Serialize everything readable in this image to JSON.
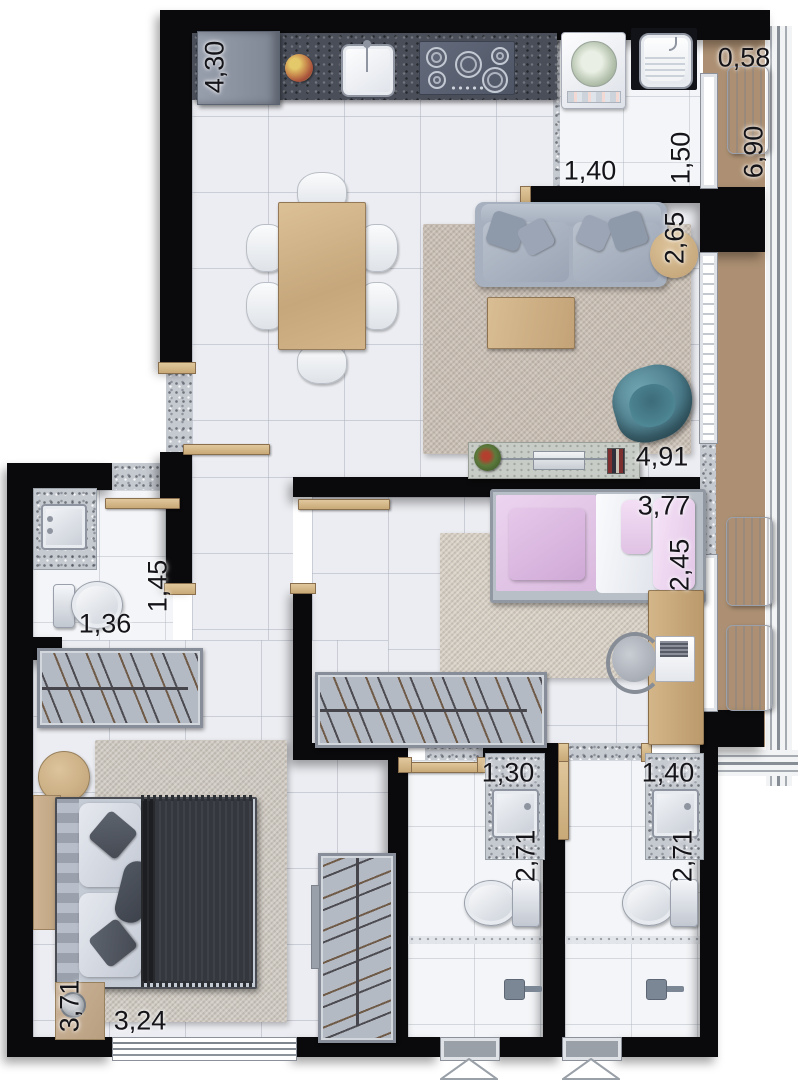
{
  "plan": {
    "type": "apartment-floor-plan",
    "unit": "meters",
    "dimensions": {
      "kitchen_counter": "4,30",
      "balcony_width": "0,58",
      "balcony_length": "6,90",
      "laundry_width": "1,40",
      "laundry_depth": "1,50",
      "living_width": "2,65",
      "living_length": "4,91",
      "bedroom2_length": "3,77",
      "bedroom2_width": "2,45",
      "wc_depth": "1,45",
      "wc_width": "1,36",
      "bathroom1_width": "1,30",
      "bathroom1_depth": "2,71",
      "bathroom2_width": "1,40",
      "bathroom2_depth": "2,71",
      "master_width": "3,71",
      "master_length": "3,24"
    },
    "colors": {
      "wall": "#0a0a0c",
      "floor_tile": "#ecedf2",
      "balcony_wood": "#ad9073",
      "counter_dark": "#494e59",
      "granite": "#c5c9d0",
      "rug_living": "#c9bfb4",
      "sofa": "#a7b0bf",
      "armchair_teal": "#4e8795",
      "bed_single_pink": "#e2c6e6",
      "bed_double_dark": "#35383e",
      "wood_furniture": "#cfb088",
      "wardrobe_gray": "#b4bac3",
      "label_text": "#141419"
    }
  }
}
